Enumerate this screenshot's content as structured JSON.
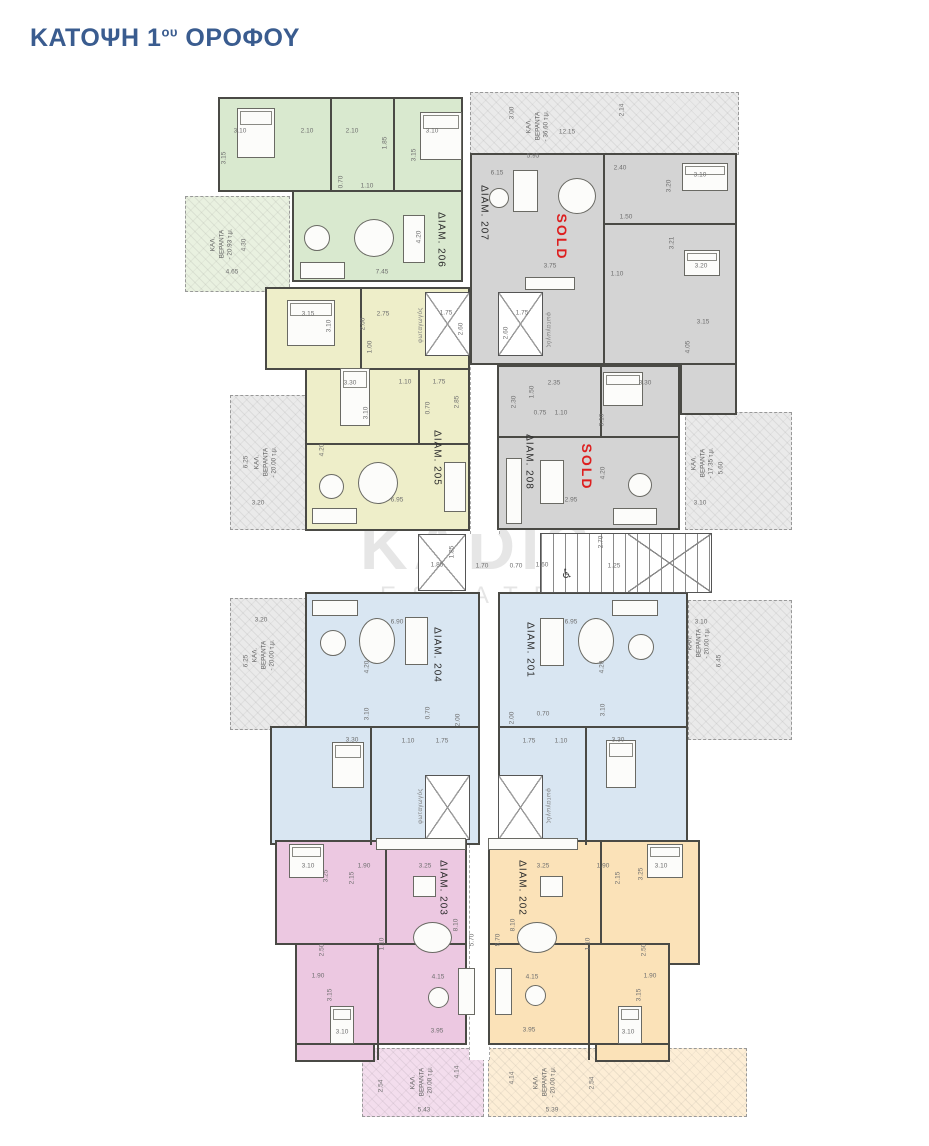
{
  "title": {
    "pre": "ΚΑΤΟΨΗ 1",
    "sup": "ου",
    "post": " ΟΡΟΦΟΥ"
  },
  "watermark": {
    "line1": "KADIS",
    "line2": "ESTATES"
  },
  "colors": {
    "title_blue": "#3a5c8f",
    "sold_red": "#dd1f1f",
    "wall": "#4a4a45",
    "green_apt": "#d9e9cf",
    "green_balcony": "#e9f1e0",
    "gray_apt": "#d4d4d4",
    "gray_balcony": "#eaeaea",
    "yellow_apt": "#eeeec9",
    "blue_apt": "#d9e6f2",
    "pink_apt": "#ecc8e1",
    "pink_balcony": "#f3dded",
    "orange_apt": "#fbe2b8",
    "orange_balcony": "#fdeed6"
  },
  "apartments": [
    {
      "label": "ΔΙΑΜ. 206",
      "color": "#d9e9cf",
      "status": ""
    },
    {
      "label": "ΔΙΑΜ. 207",
      "color": "#d4d4d4",
      "status": "SOLD"
    },
    {
      "label": "ΔΙΑΜ. 205",
      "color": "#eeeec9",
      "status": ""
    },
    {
      "label": "ΔΙΑΜ. 208",
      "color": "#d4d4d4",
      "status": "SOLD"
    },
    {
      "label": "ΔΙΑΜ. 204",
      "color": "#d9e6f2",
      "status": ""
    },
    {
      "label": "ΔΙΑΜ. 201",
      "color": "#d9e6f2",
      "status": ""
    },
    {
      "label": "ΔΙΑΜ. 203",
      "color": "#ecc8e1",
      "status": ""
    },
    {
      "label": "ΔΙΑΜ. 202",
      "color": "#fbe2b8",
      "status": ""
    }
  ],
  "labels": [
    {
      "t": "3.10",
      "x": 240,
      "y": 131
    },
    {
      "t": "3.15",
      "x": 224,
      "y": 158,
      "r": -90
    },
    {
      "t": "2.10",
      "x": 307,
      "y": 131
    },
    {
      "t": "2.10",
      "x": 352,
      "y": 131
    },
    {
      "t": "1.85",
      "x": 385,
      "y": 143,
      "r": -90
    },
    {
      "t": "3.10",
      "x": 432,
      "y": 131
    },
    {
      "t": "3.15",
      "x": 414,
      "y": 155,
      "r": -90
    },
    {
      "t": "0.70",
      "x": 341,
      "y": 182,
      "r": -90
    },
    {
      "t": "1.10",
      "x": 367,
      "y": 186
    },
    {
      "t": "4.30",
      "x": 244,
      "y": 245,
      "r": -90
    },
    {
      "t": "4.65",
      "x": 232,
      "y": 272
    },
    {
      "t": "ΚΑΛ.\nΒΕΡΑΝΤΑ\n- 20.93 τ.μ.",
      "x": 222,
      "y": 244,
      "r": -90,
      "c": "b"
    },
    {
      "t": "7.45",
      "x": 382,
      "y": 272
    },
    {
      "t": "4.20",
      "x": 419,
      "y": 237,
      "r": -90
    },
    {
      "t": "ΔΙΑΜ. 206",
      "x": 441,
      "y": 240,
      "r": 90,
      "c": "a"
    },
    {
      "t": "3.00",
      "x": 512,
      "y": 113,
      "r": -90
    },
    {
      "t": "ΚΑΛ.\nΒΕΡΑΝΤΑ\n- 36.60 τ.μ.",
      "x": 538,
      "y": 126,
      "r": -90,
      "c": "b"
    },
    {
      "t": "12.15",
      "x": 567,
      "y": 132
    },
    {
      "t": "2.14",
      "x": 622,
      "y": 110,
      "r": -90
    },
    {
      "t": "5.95",
      "x": 533,
      "y": 156
    },
    {
      "t": "6.15",
      "x": 497,
      "y": 173
    },
    {
      "t": "ΔΙΑΜ. 207",
      "x": 484,
      "y": 213,
      "r": 90,
      "c": "a"
    },
    {
      "t": "SOLD",
      "x": 562,
      "y": 237,
      "r": 90,
      "c": "s"
    },
    {
      "t": "2.40",
      "x": 620,
      "y": 168
    },
    {
      "t": "3.10",
      "x": 700,
      "y": 175
    },
    {
      "t": "3.20",
      "x": 669,
      "y": 186,
      "r": -90
    },
    {
      "t": "1.50",
      "x": 626,
      "y": 217
    },
    {
      "t": "3.75",
      "x": 550,
      "y": 266
    },
    {
      "t": "3.21",
      "x": 672,
      "y": 243,
      "r": -90
    },
    {
      "t": "3.20",
      "x": 701,
      "y": 266
    },
    {
      "t": "1.10",
      "x": 617,
      "y": 274
    },
    {
      "t": "3.15",
      "x": 703,
      "y": 322
    },
    {
      "t": "4.05",
      "x": 688,
      "y": 347,
      "r": -90
    },
    {
      "t": "1.75",
      "x": 446,
      "y": 313
    },
    {
      "t": "2.60",
      "x": 461,
      "y": 329,
      "r": -90
    },
    {
      "t": "φωταγωγός",
      "x": 421,
      "y": 325,
      "r": -90,
      "c": "f"
    },
    {
      "t": "1.75",
      "x": 522,
      "y": 313
    },
    {
      "t": "2.60",
      "x": 506,
      "y": 333,
      "r": -90
    },
    {
      "t": "φωταγωγός",
      "x": 548,
      "y": 330,
      "r": 90,
      "c": "f"
    },
    {
      "t": "3.15",
      "x": 308,
      "y": 314
    },
    {
      "t": "3.10",
      "x": 329,
      "y": 326,
      "r": -90
    },
    {
      "t": "2.75",
      "x": 383,
      "y": 314
    },
    {
      "t": "2.00",
      "x": 363,
      "y": 324,
      "r": -90
    },
    {
      "t": "1.00",
      "x": 370,
      "y": 347,
      "r": -90
    },
    {
      "t": "3.30",
      "x": 350,
      "y": 383
    },
    {
      "t": "1.10",
      "x": 405,
      "y": 382
    },
    {
      "t": "1.75",
      "x": 439,
      "y": 382
    },
    {
      "t": "2.85",
      "x": 457,
      "y": 402,
      "r": -90
    },
    {
      "t": "0.70",
      "x": 428,
      "y": 408,
      "r": -90
    },
    {
      "t": "3.10",
      "x": 366,
      "y": 413,
      "r": -90
    },
    {
      "t": "ΔΙΑΜ. 205",
      "x": 437,
      "y": 458,
      "r": 90,
      "c": "a"
    },
    {
      "t": "4.20",
      "x": 322,
      "y": 450,
      "r": -90
    },
    {
      "t": "6.95",
      "x": 397,
      "y": 500
    },
    {
      "t": "ΚΑΛ.\nΒΕΡΑΝΤΑ\n- 20.00 τ.μ.",
      "x": 266,
      "y": 462,
      "r": -90,
      "c": "b"
    },
    {
      "t": "6.25",
      "x": 246,
      "y": 462,
      "r": -90
    },
    {
      "t": "3.20",
      "x": 258,
      "y": 503
    },
    {
      "t": "2.35",
      "x": 554,
      "y": 383
    },
    {
      "t": "3.30",
      "x": 645,
      "y": 383
    },
    {
      "t": "1.50",
      "x": 532,
      "y": 392,
      "r": -90
    },
    {
      "t": "2.30",
      "x": 514,
      "y": 402,
      "r": -90
    },
    {
      "t": "0.75",
      "x": 540,
      "y": 413
    },
    {
      "t": "1.10",
      "x": 561,
      "y": 413
    },
    {
      "t": "3.10",
      "x": 602,
      "y": 420,
      "r": -90
    },
    {
      "t": "ΔΙΑΜ. 208",
      "x": 529,
      "y": 462,
      "r": 90,
      "c": "a"
    },
    {
      "t": "SOLD",
      "x": 587,
      "y": 467,
      "r": 90,
      "c": "s"
    },
    {
      "t": "4.20",
      "x": 603,
      "y": 473,
      "r": -90
    },
    {
      "t": "2.95",
      "x": 571,
      "y": 500
    },
    {
      "t": "ΚΑΛ.\nΒΕΡΑΝΤΑ\n- 17.35 τ.μ.",
      "x": 703,
      "y": 463,
      "r": -90,
      "c": "b"
    },
    {
      "t": "5.60",
      "x": 721,
      "y": 468,
      "r": -90
    },
    {
      "t": "3.10",
      "x": 700,
      "y": 503
    },
    {
      "t": "1.85",
      "x": 437,
      "y": 565
    },
    {
      "t": "1.85",
      "x": 452,
      "y": 552,
      "r": -90
    },
    {
      "t": "1.70",
      "x": 482,
      "y": 566
    },
    {
      "t": "0.70",
      "x": 516,
      "y": 566
    },
    {
      "t": "1.60",
      "x": 542,
      "y": 565
    },
    {
      "t": "2.70",
      "x": 601,
      "y": 542,
      "r": -90
    },
    {
      "t": "1.25",
      "x": 614,
      "y": 566
    },
    {
      "t": "6.90",
      "x": 397,
      "y": 622
    },
    {
      "t": "ΔΙΑΜ. 204",
      "x": 437,
      "y": 655,
      "r": 90,
      "c": "a"
    },
    {
      "t": "4.20",
      "x": 367,
      "y": 667,
      "r": -90
    },
    {
      "t": "3.10",
      "x": 367,
      "y": 714,
      "r": -90
    },
    {
      "t": "3.30",
      "x": 352,
      "y": 740
    },
    {
      "t": "1.10",
      "x": 408,
      "y": 741
    },
    {
      "t": "1.75",
      "x": 442,
      "y": 741
    },
    {
      "t": "2.00",
      "x": 458,
      "y": 720,
      "r": -90
    },
    {
      "t": "0.70",
      "x": 428,
      "y": 713,
      "r": -90
    },
    {
      "t": "ΚΑΛ.\nΒΕΡΑΝΤΑ\n- 20.00 τ.μ.",
      "x": 264,
      "y": 655,
      "r": -90,
      "c": "b"
    },
    {
      "t": "3.20",
      "x": 261,
      "y": 620
    },
    {
      "t": "6.25",
      "x": 246,
      "y": 661,
      "r": -90
    },
    {
      "t": "6.95",
      "x": 571,
      "y": 622
    },
    {
      "t": "ΔΙΑΜ. 201",
      "x": 530,
      "y": 650,
      "r": 90,
      "c": "a"
    },
    {
      "t": "4.20",
      "x": 602,
      "y": 667,
      "r": -90
    },
    {
      "t": "3.10",
      "x": 603,
      "y": 710,
      "r": -90
    },
    {
      "t": "3.30",
      "x": 618,
      "y": 740
    },
    {
      "t": "1.10",
      "x": 561,
      "y": 741
    },
    {
      "t": "1.75",
      "x": 529,
      "y": 741
    },
    {
      "t": "0.70",
      "x": 543,
      "y": 714
    },
    {
      "t": "2.00",
      "x": 512,
      "y": 718,
      "r": -90
    },
    {
      "t": "ΚΑΛ.\nΒΕΡΑΝΤΑ\n- 20.00 τ.μ.",
      "x": 699,
      "y": 643,
      "r": -90,
      "c": "b"
    },
    {
      "t": "3.10",
      "x": 701,
      "y": 622
    },
    {
      "t": "6.45",
      "x": 719,
      "y": 661,
      "r": -90
    },
    {
      "t": "φωταγωγός",
      "x": 421,
      "y": 806,
      "r": -90,
      "c": "f"
    },
    {
      "t": "φωταγωγός",
      "x": 548,
      "y": 806,
      "r": 90,
      "c": "f"
    },
    {
      "t": "3.10",
      "x": 308,
      "y": 866
    },
    {
      "t": "3.25",
      "x": 326,
      "y": 876,
      "r": -90
    },
    {
      "t": "1.90",
      "x": 364,
      "y": 866
    },
    {
      "t": "2.15",
      "x": 352,
      "y": 878,
      "r": -90
    },
    {
      "t": "3.25",
      "x": 425,
      "y": 866
    },
    {
      "t": "ΔΙΑΜ. 203",
      "x": 443,
      "y": 888,
      "r": 90,
      "c": "a"
    },
    {
      "t": "8.10",
      "x": 456,
      "y": 925,
      "r": -90
    },
    {
      "t": "5.70",
      "x": 472,
      "y": 940,
      "r": -90
    },
    {
      "t": "2.50",
      "x": 322,
      "y": 950,
      "r": -90
    },
    {
      "t": "1.90",
      "x": 318,
      "y": 976
    },
    {
      "t": "3.15",
      "x": 330,
      "y": 995,
      "r": -90
    },
    {
      "t": "1.10",
      "x": 382,
      "y": 944,
      "r": -90
    },
    {
      "t": "4.15",
      "x": 438,
      "y": 977
    },
    {
      "t": "3.10",
      "x": 342,
      "y": 1032
    },
    {
      "t": "3.95",
      "x": 437,
      "y": 1031
    },
    {
      "t": "ΚΑΛ.\nΒΕΡΑΝΤΑ\n- 20.00 τ.μ.",
      "x": 422,
      "y": 1082,
      "r": -90,
      "c": "b"
    },
    {
      "t": "4.14",
      "x": 457,
      "y": 1072,
      "r": -90
    },
    {
      "t": "2.54",
      "x": 381,
      "y": 1086,
      "r": -90
    },
    {
      "t": "5.43",
      "x": 424,
      "y": 1110
    },
    {
      "t": "3.25",
      "x": 543,
      "y": 866
    },
    {
      "t": "1.90",
      "x": 603,
      "y": 866
    },
    {
      "t": "2.15",
      "x": 618,
      "y": 878,
      "r": -90
    },
    {
      "t": "3.10",
      "x": 661,
      "y": 866
    },
    {
      "t": "3.25",
      "x": 641,
      "y": 874,
      "r": -90
    },
    {
      "t": "ΔΙΑΜ. 202",
      "x": 522,
      "y": 888,
      "r": 90,
      "c": "a"
    },
    {
      "t": "8.10",
      "x": 513,
      "y": 925,
      "r": -90
    },
    {
      "t": "5.70",
      "x": 498,
      "y": 940,
      "r": -90
    },
    {
      "t": "1.10",
      "x": 588,
      "y": 944,
      "r": -90
    },
    {
      "t": "2.50",
      "x": 644,
      "y": 950,
      "r": -90
    },
    {
      "t": "1.90",
      "x": 650,
      "y": 976
    },
    {
      "t": "3.15",
      "x": 639,
      "y": 995,
      "r": -90
    },
    {
      "t": "4.15",
      "x": 532,
      "y": 977
    },
    {
      "t": "3.10",
      "x": 628,
      "y": 1032
    },
    {
      "t": "3.95",
      "x": 529,
      "y": 1030
    },
    {
      "t": "ΚΑΛ.\nΒΕΡΑΝΤΑ\n- 20.00 τ.μ.",
      "x": 545,
      "y": 1082,
      "r": -90,
      "c": "b"
    },
    {
      "t": "4.14",
      "x": 512,
      "y": 1078,
      "r": -90
    },
    {
      "t": "2.54",
      "x": 592,
      "y": 1083,
      "r": -90
    },
    {
      "t": "5.39",
      "x": 552,
      "y": 1110
    }
  ]
}
